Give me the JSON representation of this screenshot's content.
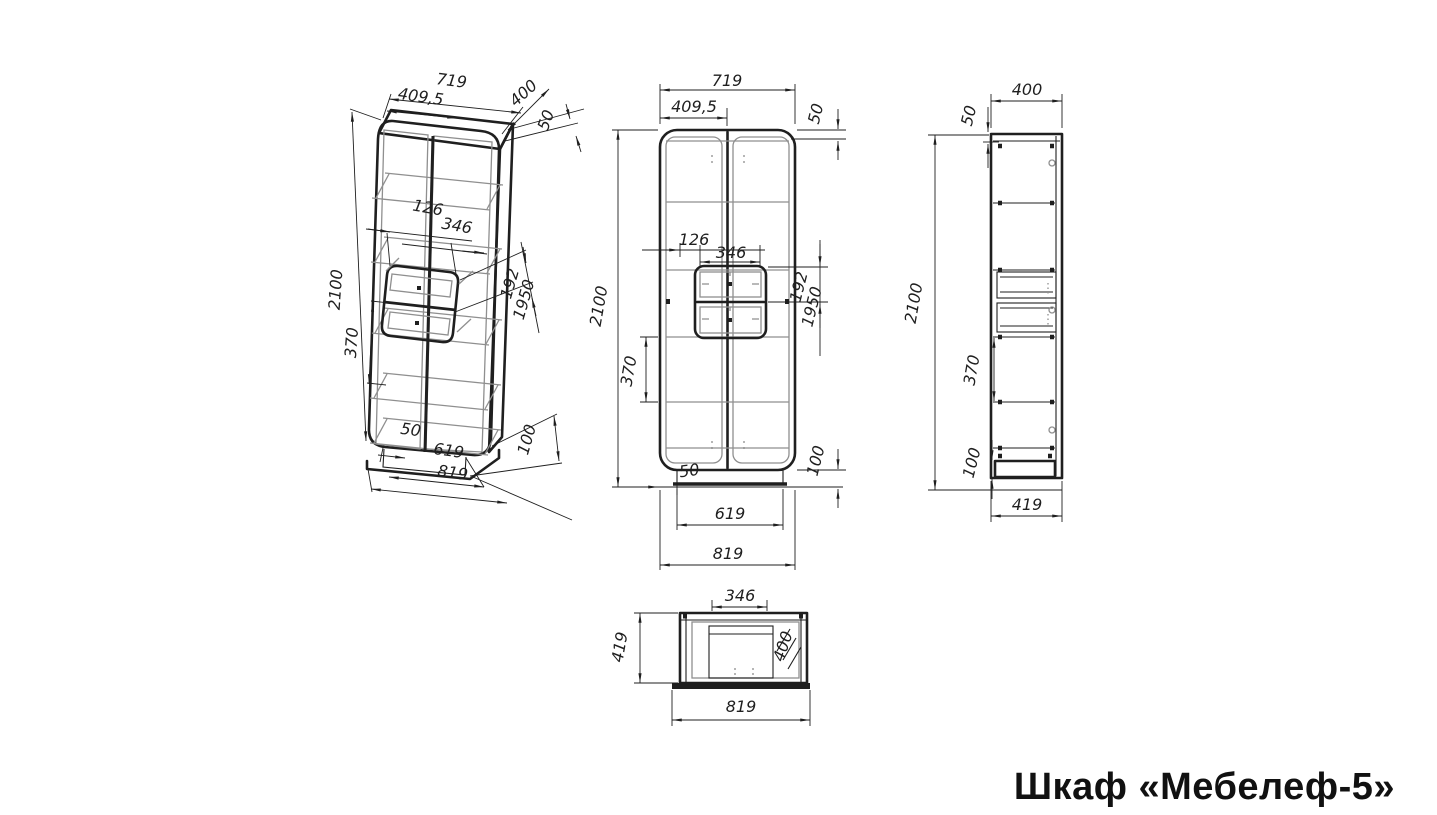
{
  "title": "Шкаф «Мебелеф-5»",
  "drawing": {
    "kind": "furniture assembly dimensions drawing",
    "product": "Шкаф «Мебелеф-5»"
  },
  "views": {
    "iso": {
      "name": "perspective-view",
      "dims": {
        "width": "719",
        "half_width": "409,5",
        "depth": "400",
        "top_panel": "50",
        "height": "2100",
        "shelf_spacing": "370",
        "drawer_offset": "126",
        "drawer_width": "346",
        "drawer_front": "192",
        "drawer_level": "1950",
        "plinth_inset": "50",
        "plinth_width": "619",
        "base_width": "819",
        "plinth_height": "100"
      }
    },
    "front": {
      "name": "front-view",
      "dims": {
        "width": "719",
        "half_width": "409,5",
        "top_panel": "50",
        "height": "2100",
        "shelf_spacing": "370",
        "drawer_offset": "126",
        "drawer_width": "346",
        "drawer_front": "192",
        "drawer_level": "1950",
        "plinth_inset": "50",
        "plinth_width": "619",
        "base_width": "819",
        "plinth_height": "100"
      }
    },
    "side": {
      "name": "side-view",
      "dims": {
        "depth": "400",
        "top_panel": "50",
        "height": "2100",
        "shelf_spacing": "370",
        "plinth_height": "100",
        "base_depth": "419"
      }
    },
    "top": {
      "name": "top-view",
      "dims": {
        "drawer_width": "346",
        "base_depth": "419",
        "depth": "400",
        "base_width": "819"
      }
    }
  },
  "colors": {
    "line": "#1f1f1f",
    "secondary_line": "#8f8f8f",
    "background": "#ffffff",
    "title_text": "#111111"
  }
}
